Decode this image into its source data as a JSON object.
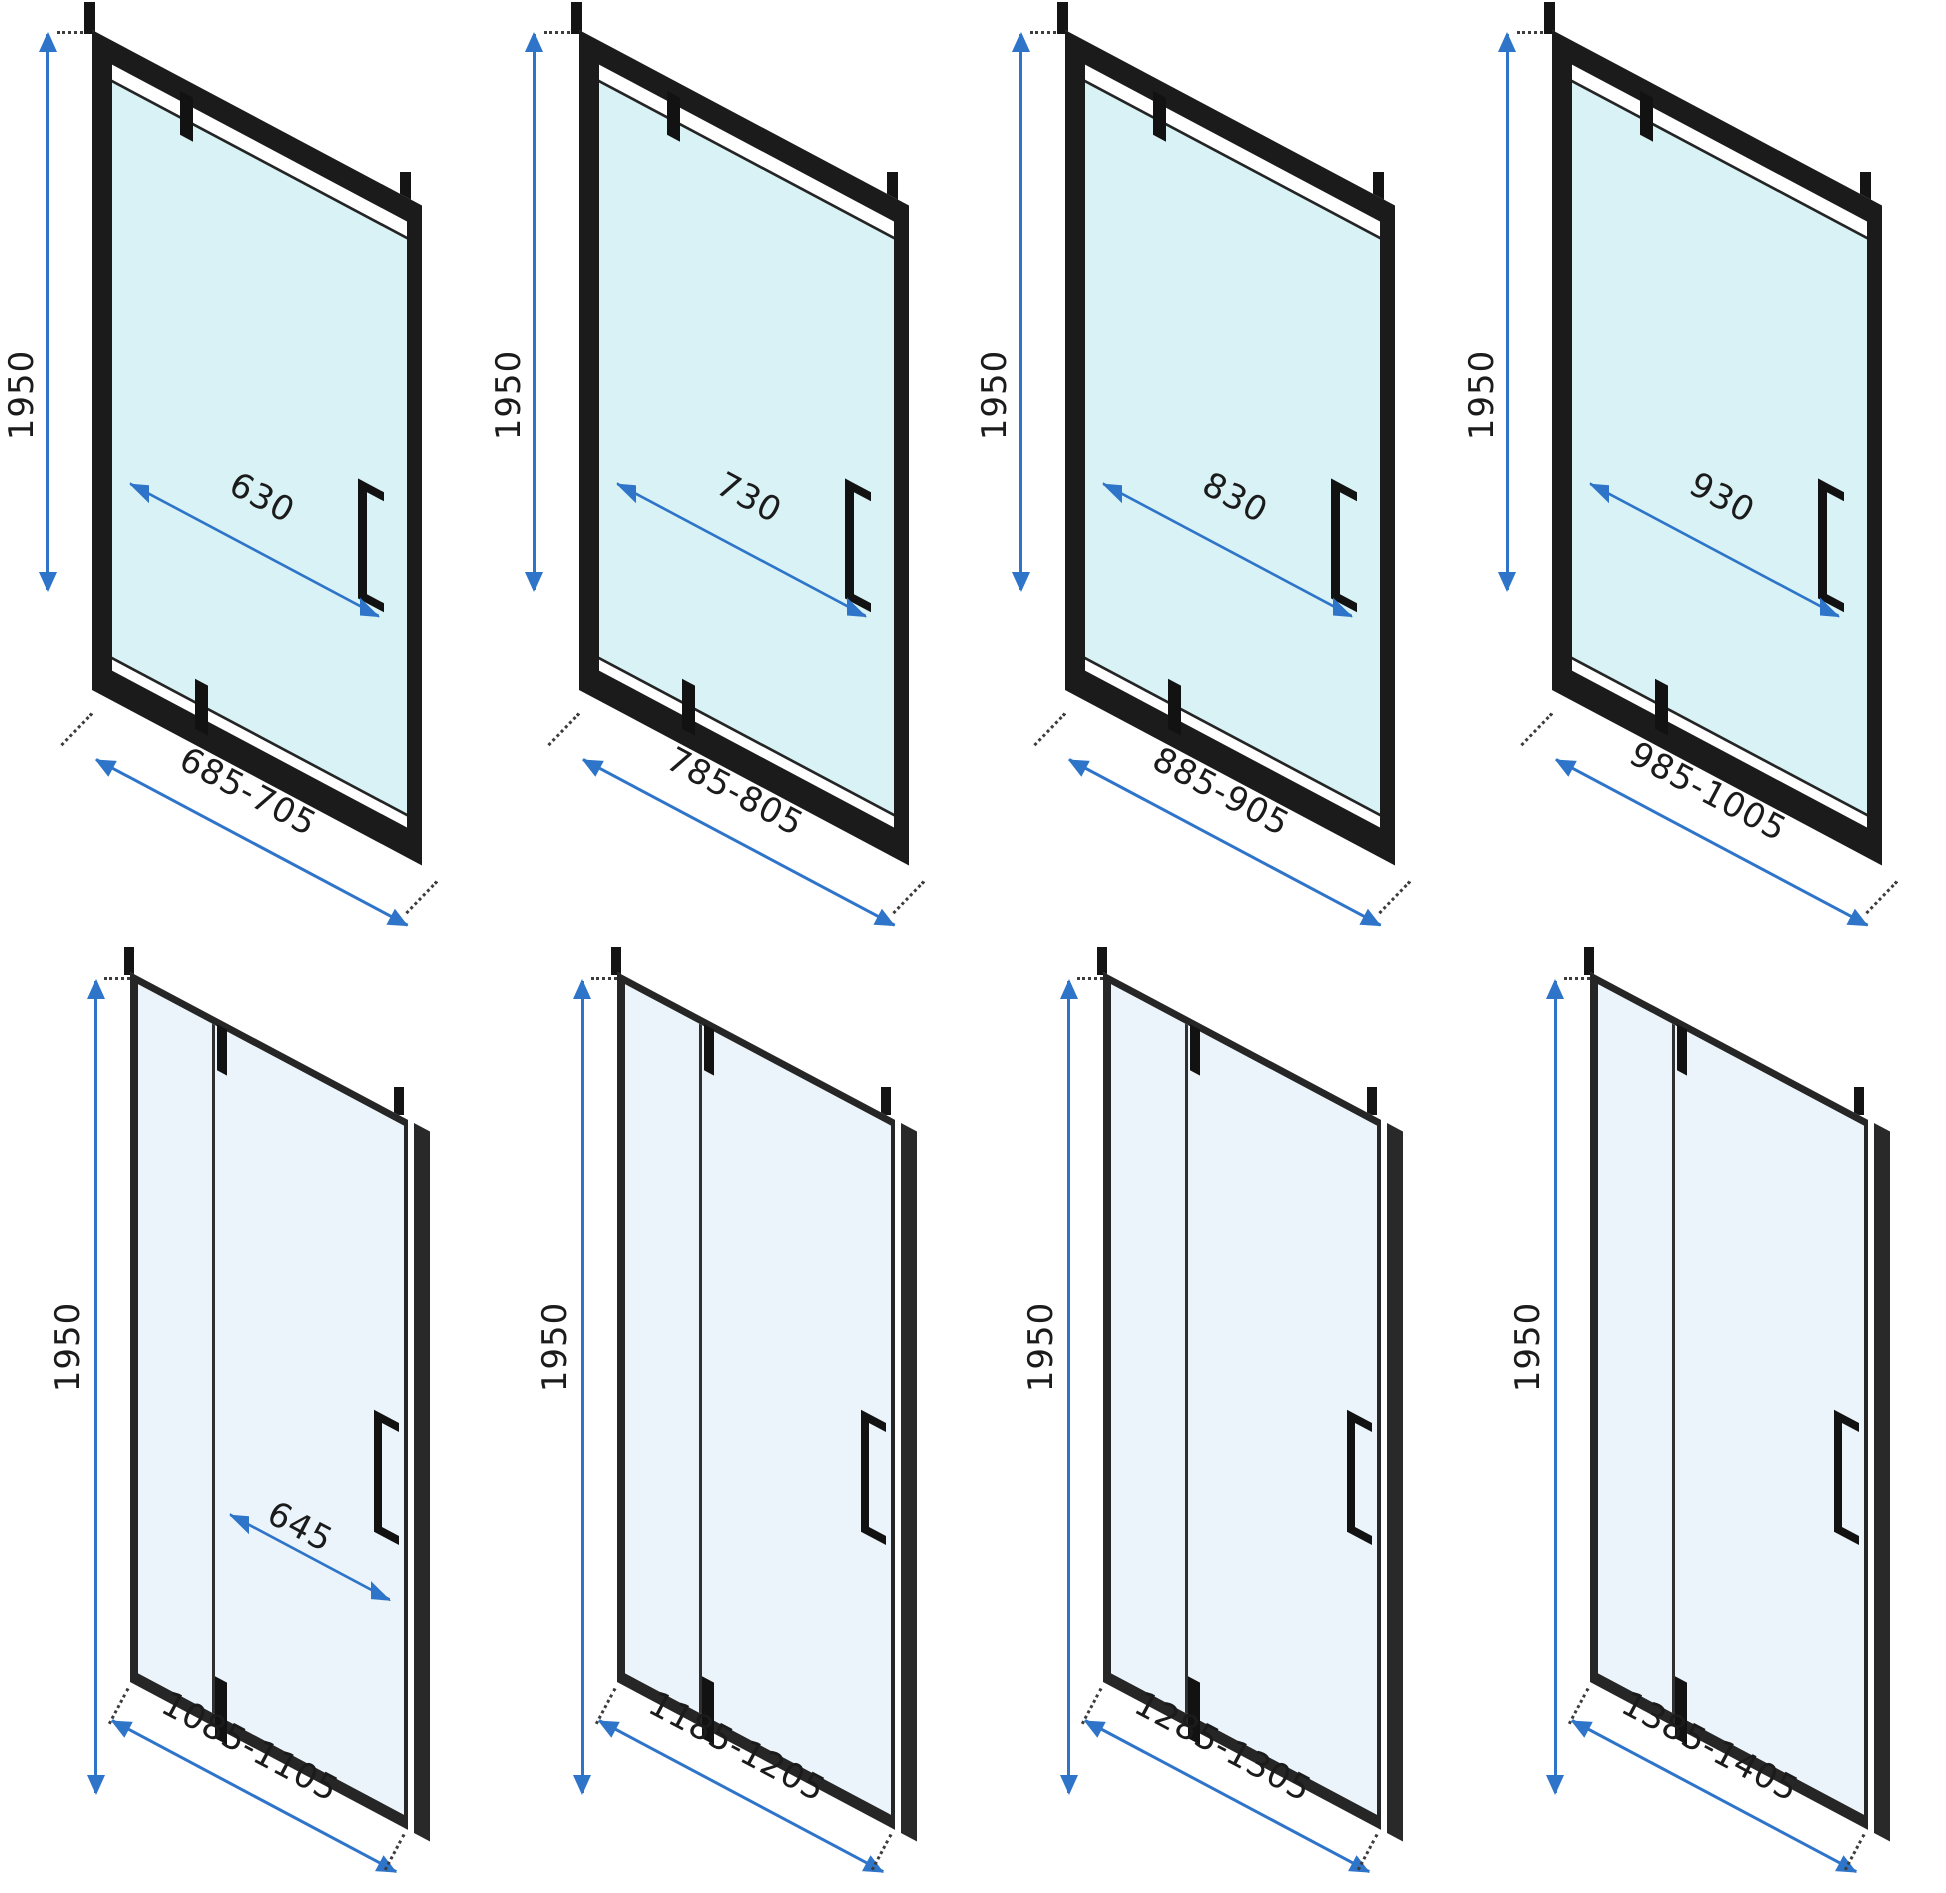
{
  "colors": {
    "dimension_blue": "#2e74c9",
    "frame_black": "#1b1b1b",
    "profile_gray": "#292929",
    "glass_cyan": "#d8f2f5",
    "glass_pale_blue": "#eaf4fa"
  },
  "doors": [
    {
      "style": "framed",
      "height_label": "1950",
      "inner_width_label": "630",
      "width_range_label": "685-705"
    },
    {
      "style": "framed",
      "height_label": "1950",
      "inner_width_label": "730",
      "width_range_label": "785-805"
    },
    {
      "style": "framed",
      "height_label": "1950",
      "inner_width_label": "830",
      "width_range_label": "885-905"
    },
    {
      "style": "framed",
      "height_label": "1950",
      "inner_width_label": "930",
      "width_range_label": "985-1005"
    },
    {
      "style": "sliding",
      "height_label": "1950",
      "inner_width_label": "645",
      "width_range_label": "1085-1105"
    },
    {
      "style": "sliding",
      "height_label": "1950",
      "inner_width_label": null,
      "width_range_label": "1185-1205"
    },
    {
      "style": "sliding",
      "height_label": "1950",
      "inner_width_label": null,
      "width_range_label": "1285-1305"
    },
    {
      "style": "sliding",
      "height_label": "1950",
      "inner_width_label": null,
      "width_range_label": "1385-1405"
    }
  ]
}
